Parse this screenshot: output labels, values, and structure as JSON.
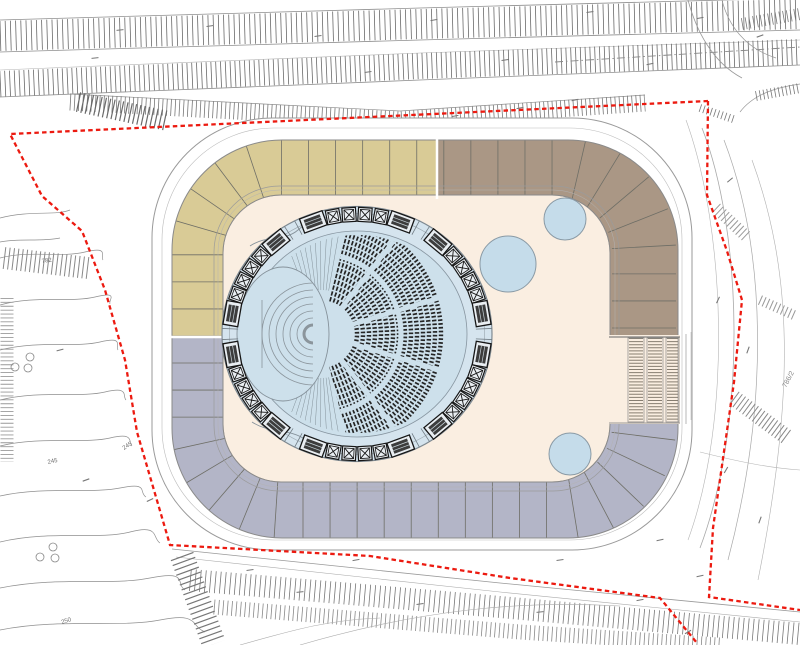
{
  "meta": {
    "drawing_type": "architectural site plan",
    "subject": "circular auditorium hall inside rounded program ring with site boundary and terrain contours"
  },
  "palette": {
    "background": "#ffffff",
    "boundary_red": "#ec1a10",
    "line_gray": "#8f8f8f",
    "light_line": "#b5b5b5",
    "band_tan": "#d9cb96",
    "band_brown": "#aa9785",
    "band_lavender": "#b3b5c7",
    "band_divider": "#6e6e66",
    "interior_cream": "#faeee1",
    "hall_ring_blue": "#d5e4ee",
    "hall_bowl_blue": "#cde0eb",
    "skylight_blue": "#c5dcea",
    "seat_dark": "#242424",
    "stair_hatch": "#867d70",
    "box_dark": "#161616",
    "box_fill": "#e9eef2",
    "hatch_gray": "#6a6a6a"
  },
  "site": {
    "boundary_style": "red dashed property line",
    "parcel_label": {
      "text": "786/2",
      "x": 786,
      "y": 388,
      "rot": -62
    }
  },
  "terrain": {
    "contour_labels": [
      {
        "text": "782",
        "x": 42,
        "y": 263,
        "rot": -8
      },
      {
        "text": "245",
        "x": 48,
        "y": 464,
        "rot": -12
      },
      {
        "text": "245",
        "x": 124,
        "y": 450,
        "rot": -33
      },
      {
        "text": "250",
        "x": 62,
        "y": 624,
        "rot": -18
      }
    ],
    "tree_circles": [
      [
        30,
        357
      ],
      [
        15,
        367
      ],
      [
        28,
        368
      ],
      [
        40,
        557
      ],
      [
        53,
        547
      ],
      [
        55,
        558
      ]
    ]
  },
  "building": {
    "zones": [
      {
        "name": "north-west-wing",
        "color_key": "band_tan"
      },
      {
        "name": "north-east-wing",
        "color_key": "band_brown"
      },
      {
        "name": "south-wing",
        "color_key": "band_lavender"
      }
    ],
    "skylights": [
      {
        "cx": 508,
        "cy": 264,
        "r": 28
      },
      {
        "cx": 565,
        "cy": 219,
        "r": 21
      },
      {
        "cx": 570,
        "cy": 454,
        "r": 21
      }
    ],
    "auditorium": {
      "cx": 357,
      "cy": 334,
      "rx": 135,
      "ry": 127.5,
      "seat_row_count": 15,
      "box_cluster_angles": [
        -90,
        -30,
        30,
        90,
        150,
        210
      ],
      "box_pattern": [
        "W",
        "X",
        "X",
        "X",
        "X",
        "W"
      ]
    },
    "stair_strips": [
      [
        628,
        16
      ],
      [
        647,
        16
      ],
      [
        666,
        13
      ]
    ]
  },
  "annotation_marks": [
    [
      318,
      36,
      -8
    ],
    [
      434,
      20,
      -10
    ],
    [
      590,
      12,
      -8
    ],
    [
      650,
      64,
      -12
    ],
    [
      760,
      36,
      -20
    ],
    [
      700,
      18,
      -10
    ],
    [
      368,
      72,
      -8
    ],
    [
      505,
      60,
      -8
    ],
    [
      120,
      30,
      -6
    ],
    [
      210,
      26,
      -8
    ],
    [
      95,
      58,
      -6
    ],
    [
      280,
      120,
      -10
    ],
    [
      388,
      124,
      -8
    ],
    [
      455,
      116,
      -10
    ],
    [
      520,
      108,
      -10
    ],
    [
      575,
      100,
      -12
    ],
    [
      300,
      592,
      -6
    ],
    [
      420,
      604,
      -8
    ],
    [
      540,
      612,
      -6
    ],
    [
      640,
      600,
      -10
    ],
    [
      700,
      576,
      -12
    ],
    [
      560,
      560,
      -8
    ],
    [
      250,
      570,
      -8
    ],
    [
      760,
      520,
      -70
    ],
    [
      726,
      470,
      -60
    ],
    [
      748,
      350,
      -70
    ],
    [
      718,
      300,
      -65
    ],
    [
      730,
      180,
      -40
    ],
    [
      86,
      480,
      -20
    ],
    [
      60,
      350,
      -15
    ],
    [
      150,
      500,
      -25
    ],
    [
      688,
      632,
      -30
    ],
    [
      356,
      560,
      -10
    ],
    [
      660,
      540,
      -12
    ]
  ]
}
